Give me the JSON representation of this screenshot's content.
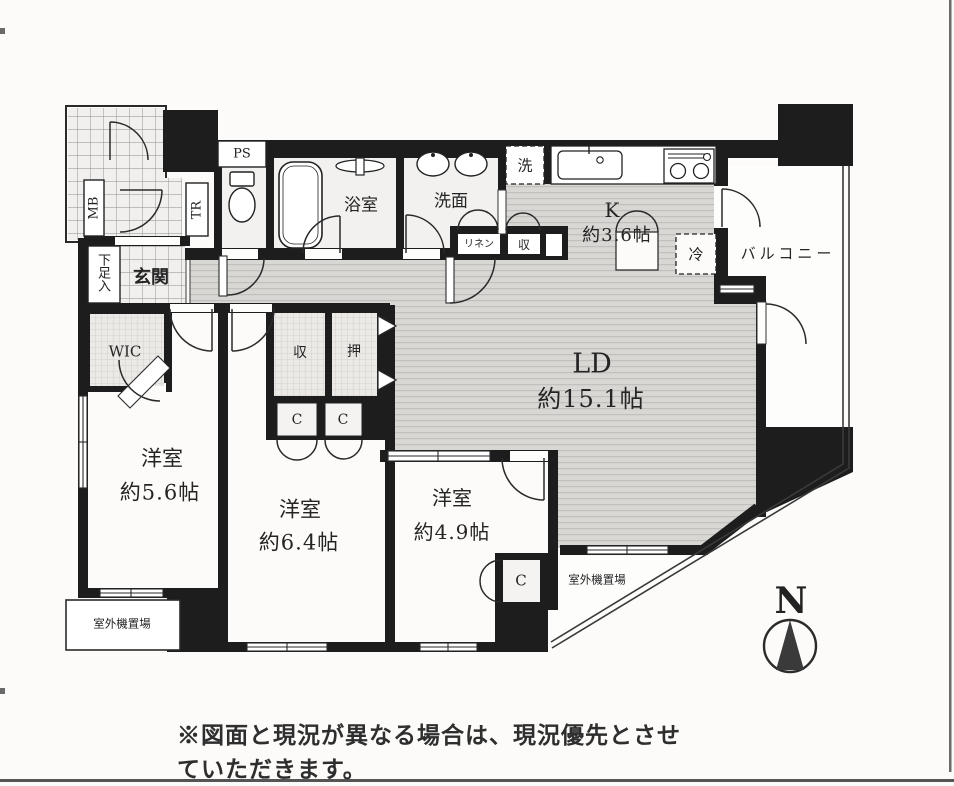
{
  "plan": {
    "rooms": {
      "ld": {
        "name": "LD",
        "size": "約15.1帖"
      },
      "kitchen": {
        "name": "K",
        "size": "約3.6帖"
      },
      "bedroom_a": {
        "name": "洋室",
        "size": "約5.6帖"
      },
      "bedroom_b": {
        "name": "洋室",
        "size": "約6.4帖"
      },
      "bedroom_c": {
        "name": "洋室",
        "size": "約4.9帖"
      },
      "bathroom": {
        "name": "浴室"
      },
      "washroom": {
        "name": "洗面"
      },
      "entrance": {
        "name": "玄関"
      },
      "wic": {
        "name": "WIC"
      },
      "balcony": {
        "name": "バルコニー"
      }
    },
    "labels": {
      "ps": "PS",
      "mb": "MB",
      "tr": "TR",
      "shoe_cabinet": "下足入",
      "washing_machine": "洗",
      "linen": "リネン",
      "hall_storage": "収",
      "storage": "収",
      "oshiire": "押",
      "closet": "C",
      "refrigerator": "冷",
      "outdoor_unit": "室外機置場"
    },
    "compass": {
      "north": "N"
    },
    "note": "※図面と現況が異なる場合は、現況優先とさせていただきます。"
  },
  "colors": {
    "wall": "#1d1d1d",
    "floor_hatch": "#d8d7d4",
    "tile": "#f1f0ee",
    "wet_floor": "#f2f1ef"
  }
}
